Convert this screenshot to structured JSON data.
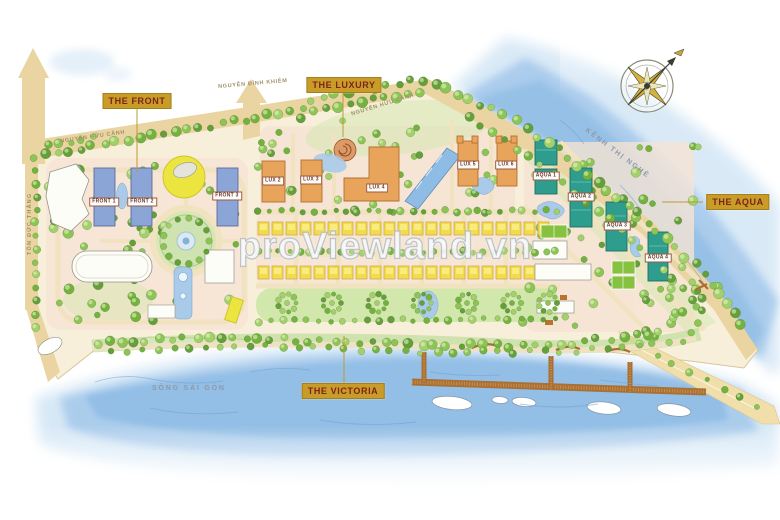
{
  "watermark": "proViewland.vn",
  "zones": [
    {
      "id": "the-front",
      "label": "THE FRONT"
    },
    {
      "id": "the-luxury",
      "label": "THE LUXURY"
    },
    {
      "id": "the-aqua",
      "label": "THE AQUA"
    },
    {
      "id": "the-victoria",
      "label": "THE VICTORIA"
    }
  ],
  "streets": {
    "ton_duc_thang": "TÔN ĐỨC THẮNG",
    "nguyen_huu_canh_left": "NGUYỄN HỮU CẢNH",
    "nguyen_dinh_khiem": "NGUYỄN ĐÌNH KHIÊM",
    "nguyen_huu_canh_right": "NGUYỄN HỮU CẢNH",
    "kenh_thi_nghe": "KÊNH THỊ NGHÈ",
    "song_sai_gon": "SÔNG SÀI GÒN"
  },
  "buildings": {
    "front": [
      {
        "label": "FRONT 1"
      },
      {
        "label": "FRONT 2"
      },
      {
        "label": "FRONT 3"
      }
    ],
    "lux": [
      {
        "label": "LUX 2"
      },
      {
        "label": "LUX 3"
      },
      {
        "label": "LUX 4"
      },
      {
        "label": "LUX 5"
      },
      {
        "label": "LUX 6"
      }
    ],
    "aqua": [
      {
        "label": "AQUA 1"
      },
      {
        "label": "AQUA 2"
      },
      {
        "label": "AQUA 3"
      },
      {
        "label": "AQUA 4"
      }
    ]
  },
  "icons": {
    "compass": "compass-rose"
  },
  "colors": {
    "zone_label_bg": "#c99c28",
    "zone_label_text": "#7a241c",
    "front_building": "#8ba5d6",
    "lux_building": "#e9a45b",
    "aqua_building": "#2f9d8d",
    "villa": "#f2dc4e",
    "water": "#8fbce4",
    "land": "#f8efdb",
    "road": "#ead5a2",
    "tree": "#7db64d",
    "pier": "#a96f33"
  }
}
